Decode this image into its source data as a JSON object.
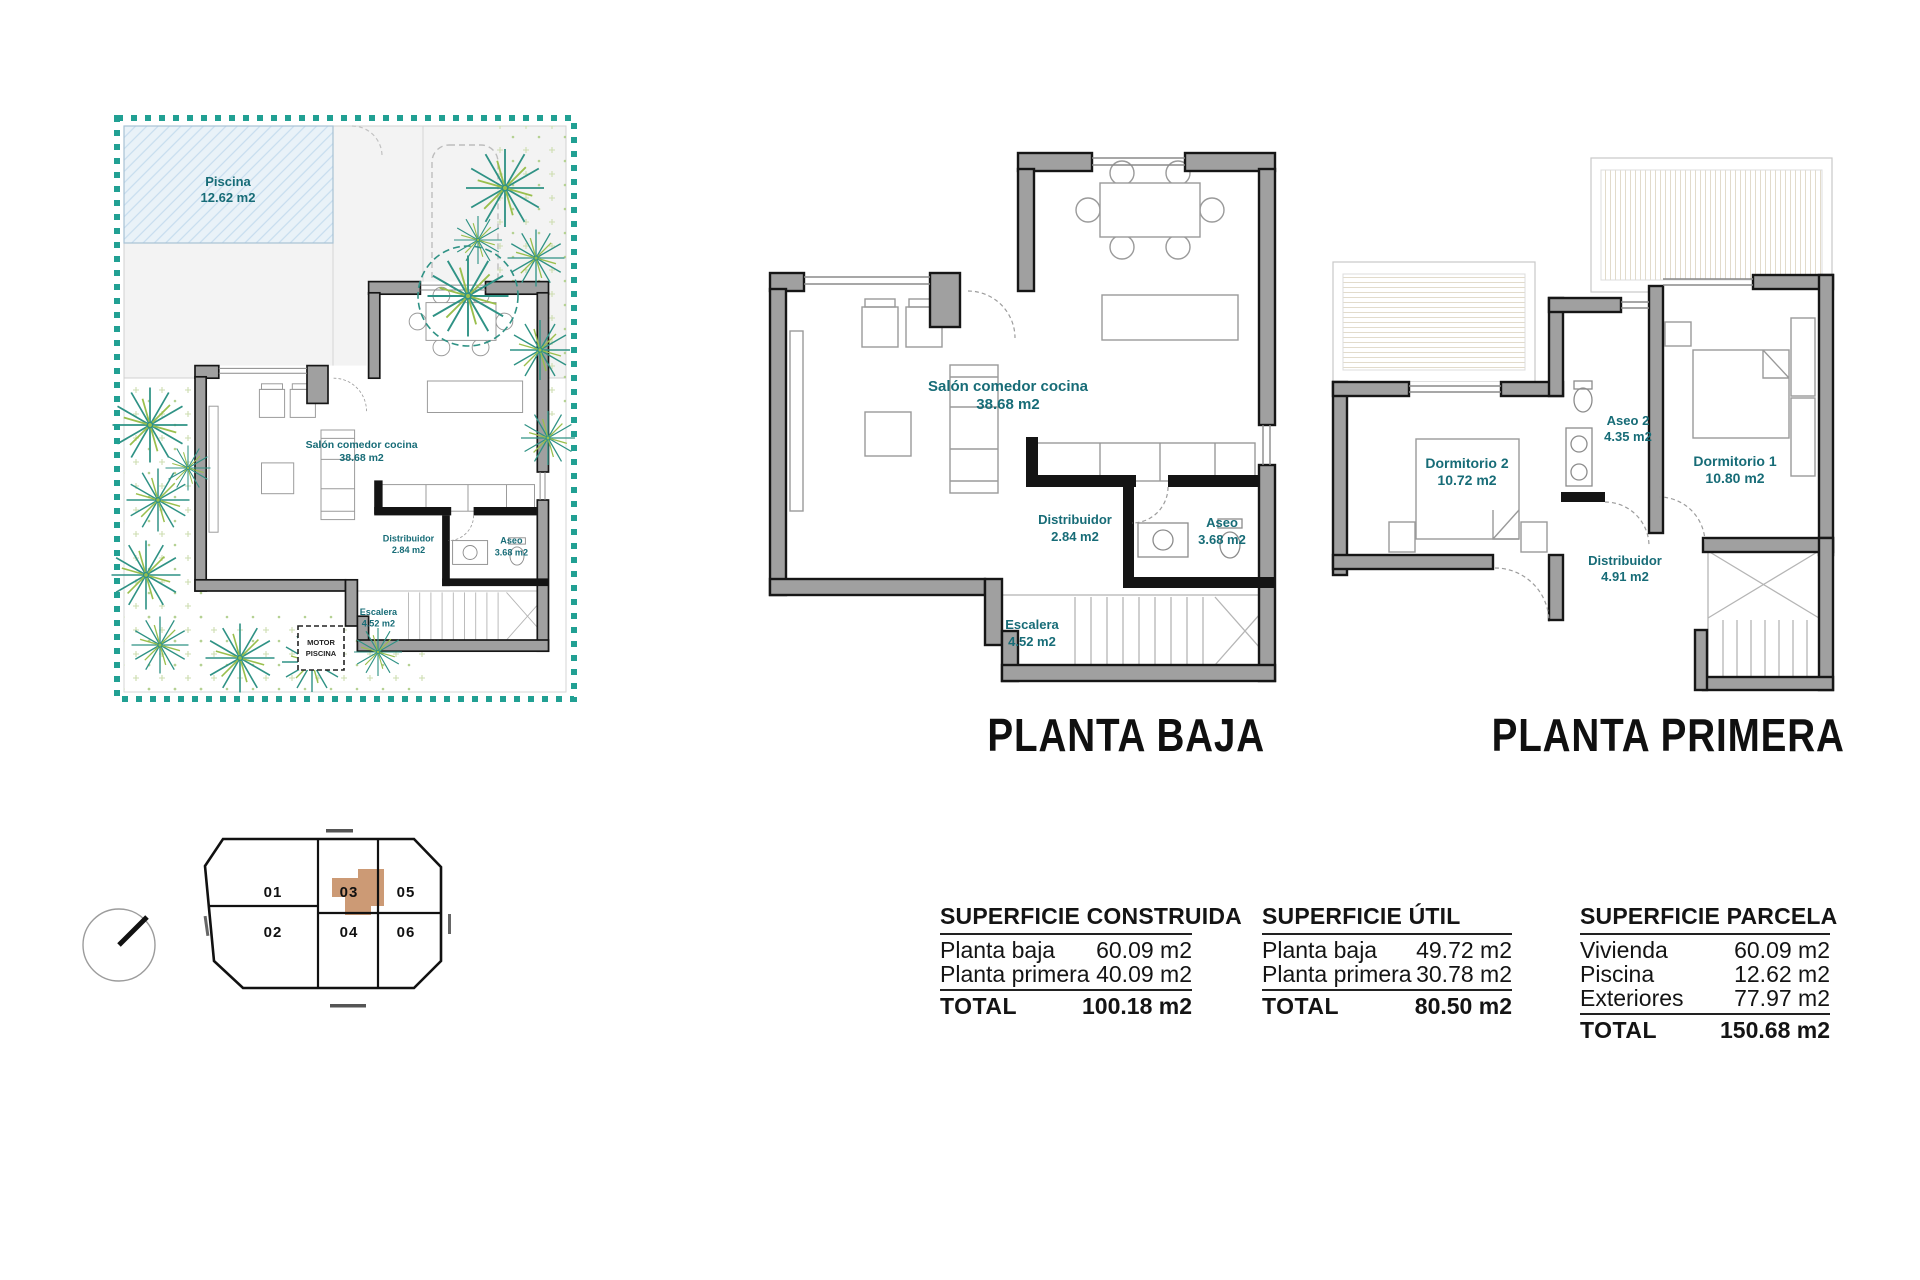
{
  "site_plan": {
    "pool": {
      "name": "Piscina",
      "area": "12.62 m2"
    },
    "motor": {
      "line1": "MOTOR",
      "line2": "PISCINA"
    }
  },
  "planta_baja": {
    "title": "PLANTA BAJA",
    "rooms": [
      {
        "name": "Salón comedor cocina",
        "area": "38.68 m2"
      },
      {
        "name": "Distribuidor",
        "area": "2.84 m2"
      },
      {
        "name": "Aseo",
        "area": "3.68 m2"
      },
      {
        "name": "Escalera",
        "area": "4.52 m2"
      }
    ]
  },
  "planta_primera": {
    "title": "PLANTA PRIMERA",
    "rooms": [
      {
        "name": "Dormitorio 2",
        "area": "10.72 m2"
      },
      {
        "name": "Aseo 2",
        "area": "4.35 m2"
      },
      {
        "name": "Dormitorio 1",
        "area": "10.80 m2"
      },
      {
        "name": "Distribuidor",
        "area": "4.91 m2"
      }
    ]
  },
  "site_key": {
    "plots": [
      "01",
      "02",
      "03",
      "04",
      "05",
      "06"
    ],
    "highlighted_plot": "03"
  },
  "tables": [
    {
      "title": "SUPERFICIE CONSTRUIDA",
      "rows": [
        [
          "Planta baja",
          "60.09 m2"
        ],
        [
          "Planta primera",
          "40.09 m2"
        ]
      ],
      "total": [
        "TOTAL",
        "100.18 m2"
      ]
    },
    {
      "title": "SUPERFICIE ÚTIL",
      "rows": [
        [
          "Planta baja",
          "49.72 m2"
        ],
        [
          "Planta primera",
          "30.78 m2"
        ]
      ],
      "total": [
        "TOTAL",
        "80.50 m2"
      ]
    },
    {
      "title": "SUPERFICIE PARCELA",
      "rows": [
        [
          "Vivienda",
          "60.09 m2"
        ],
        [
          "Piscina",
          "12.62 m2"
        ],
        [
          "Exteriores",
          "77.97 m2"
        ]
      ],
      "total": [
        "TOTAL",
        "150.68 m2"
      ]
    }
  ],
  "colors": {
    "label_teal": "#176c77",
    "boundary_teal": "#21a093",
    "wall_gray": "#a0a0a0",
    "highlight_tan": "#cc9a75"
  }
}
